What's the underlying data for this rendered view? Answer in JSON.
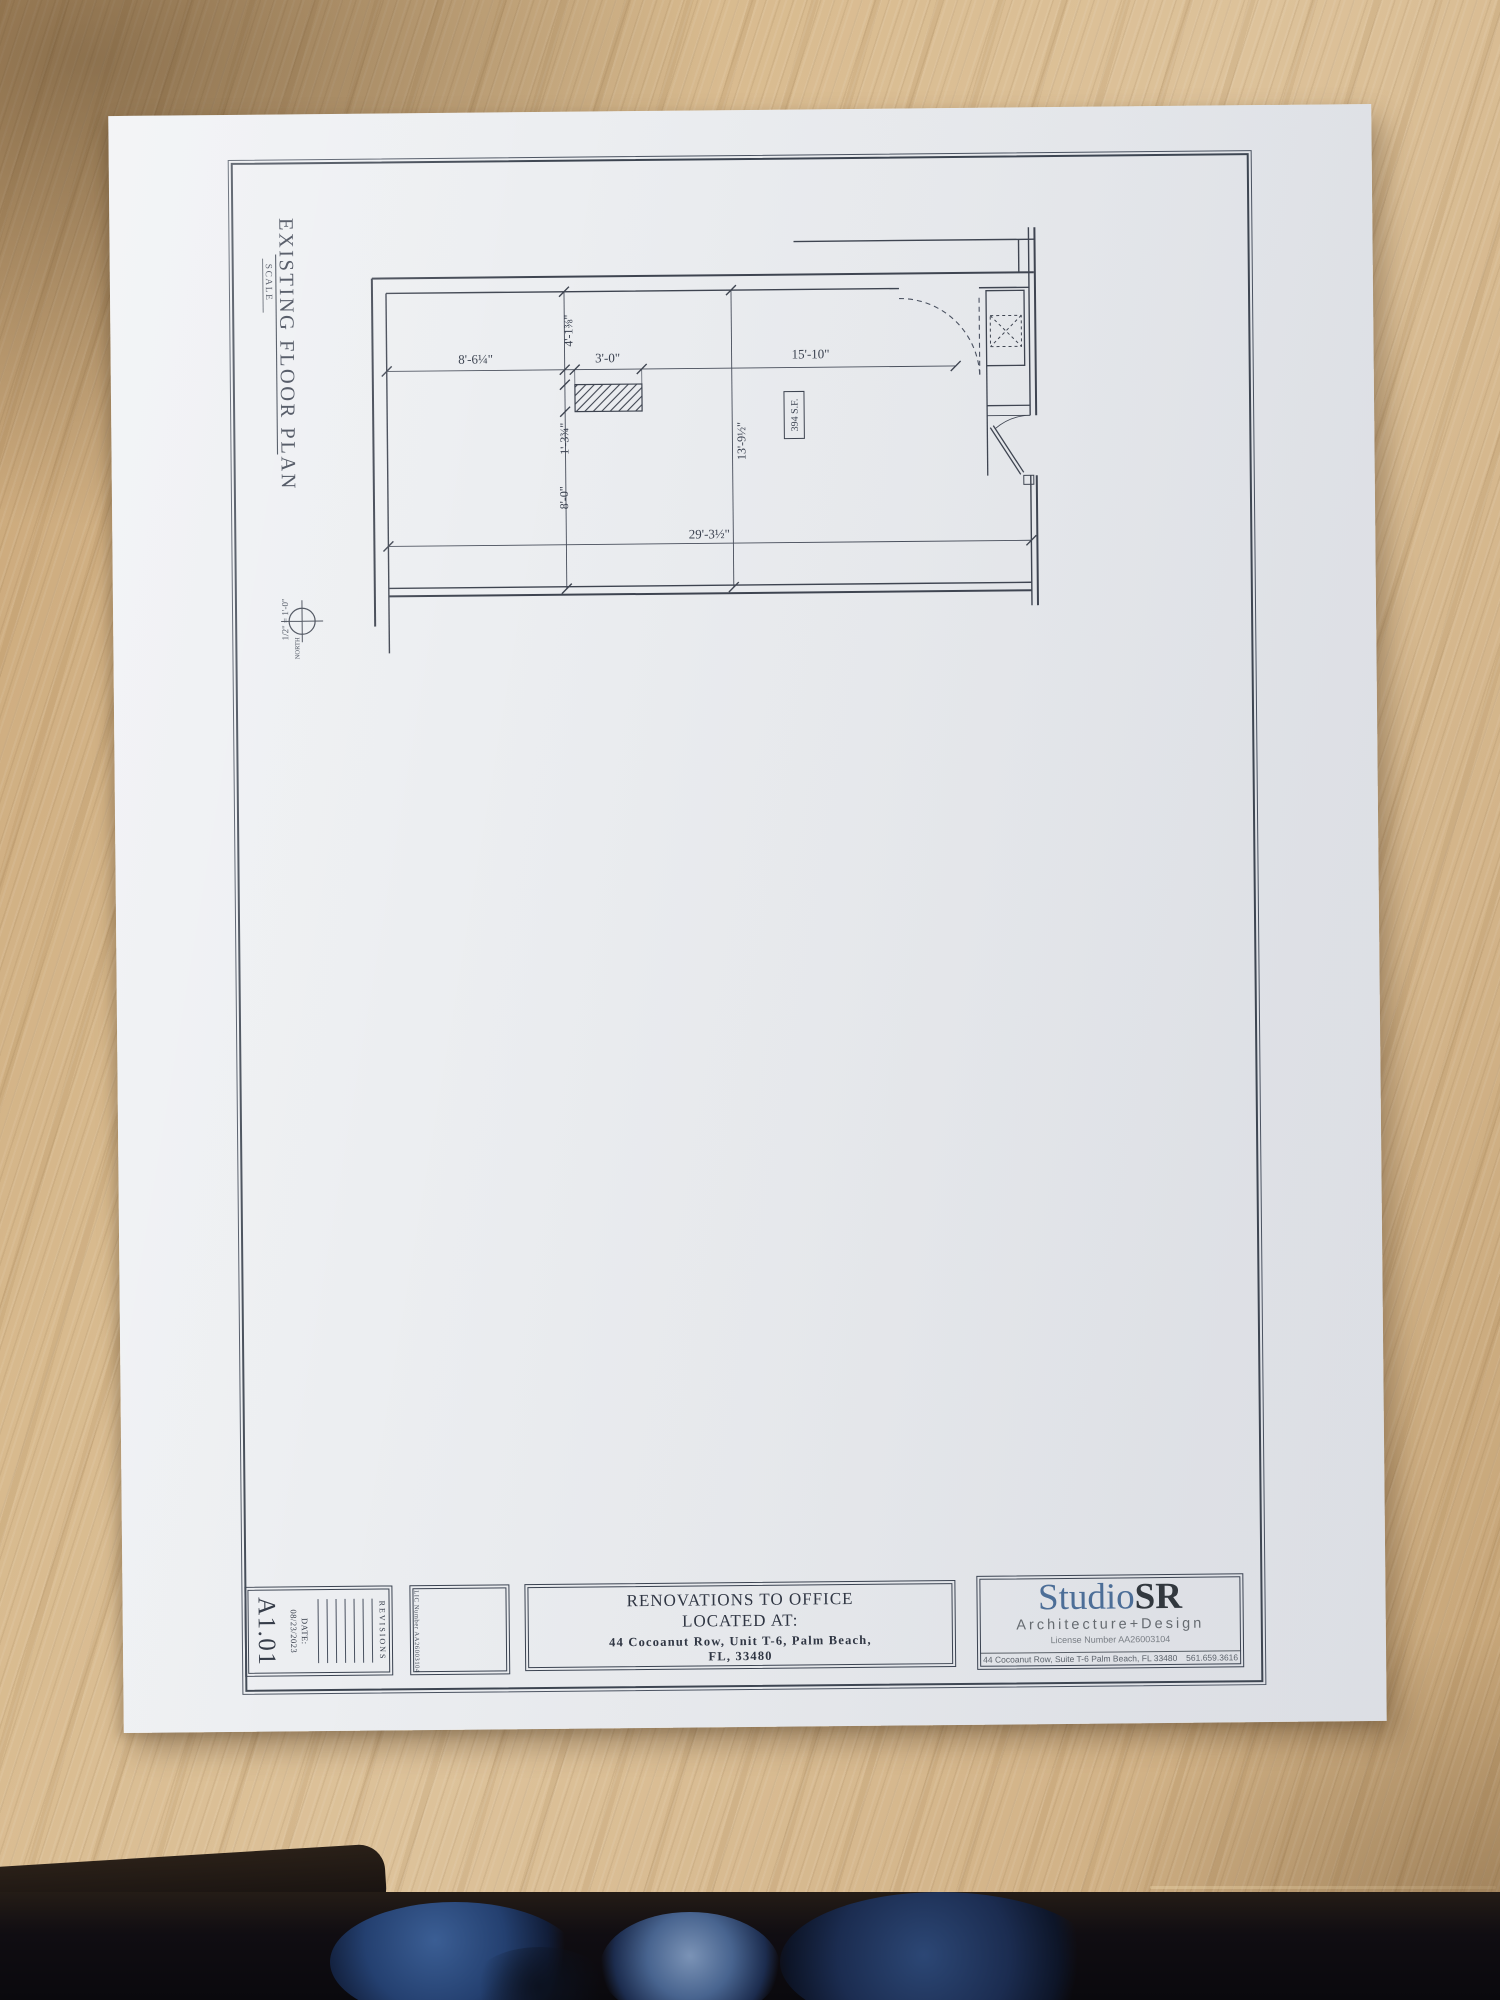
{
  "sheet": {
    "plan_title": "EXISTING FLOOR PLAN",
    "scale_label": "SCALE",
    "scale_value": "1/2\" = 1'-0\"",
    "north_label": "NORTH",
    "area_label": "394 S.F.",
    "dimensions": {
      "top_left_width": "8'-6¼\"",
      "closet_offset": "4'-1⅜\"",
      "closet_width": "3'-0\"",
      "top_right_width": "15'-10\"",
      "closet_depth": "1'-3¾\"",
      "left_height": "8'-0\"",
      "room_depth": "13'-9½\"",
      "overall_width": "29'-3½\""
    }
  },
  "title_block": {
    "sheet_number": "A1.01",
    "date_label": "DATE:",
    "date_value": "08/23/2023",
    "revisions_label": "REVISIONS",
    "license_side_label": "LIC Number AA26003104",
    "project": {
      "line1": "RENOVATIONS TO OFFICE",
      "line2": "LOCATED AT:",
      "line3": "44 Cocoanut Row, Unit T-6,  Palm Beach,",
      "line4": "FL, 33480"
    },
    "firm": {
      "name_blue": "Studio",
      "name_dark": "SR",
      "tagline": "Architecture+Design",
      "license": "License Number AA26003104",
      "address": "44 Cocoanut Row, Suite T-6 Palm Beach, FL 33480",
      "phone": "561.659.3616",
      "brand_blue": "#4b6e99",
      "ink_color": "#3a4250"
    }
  }
}
